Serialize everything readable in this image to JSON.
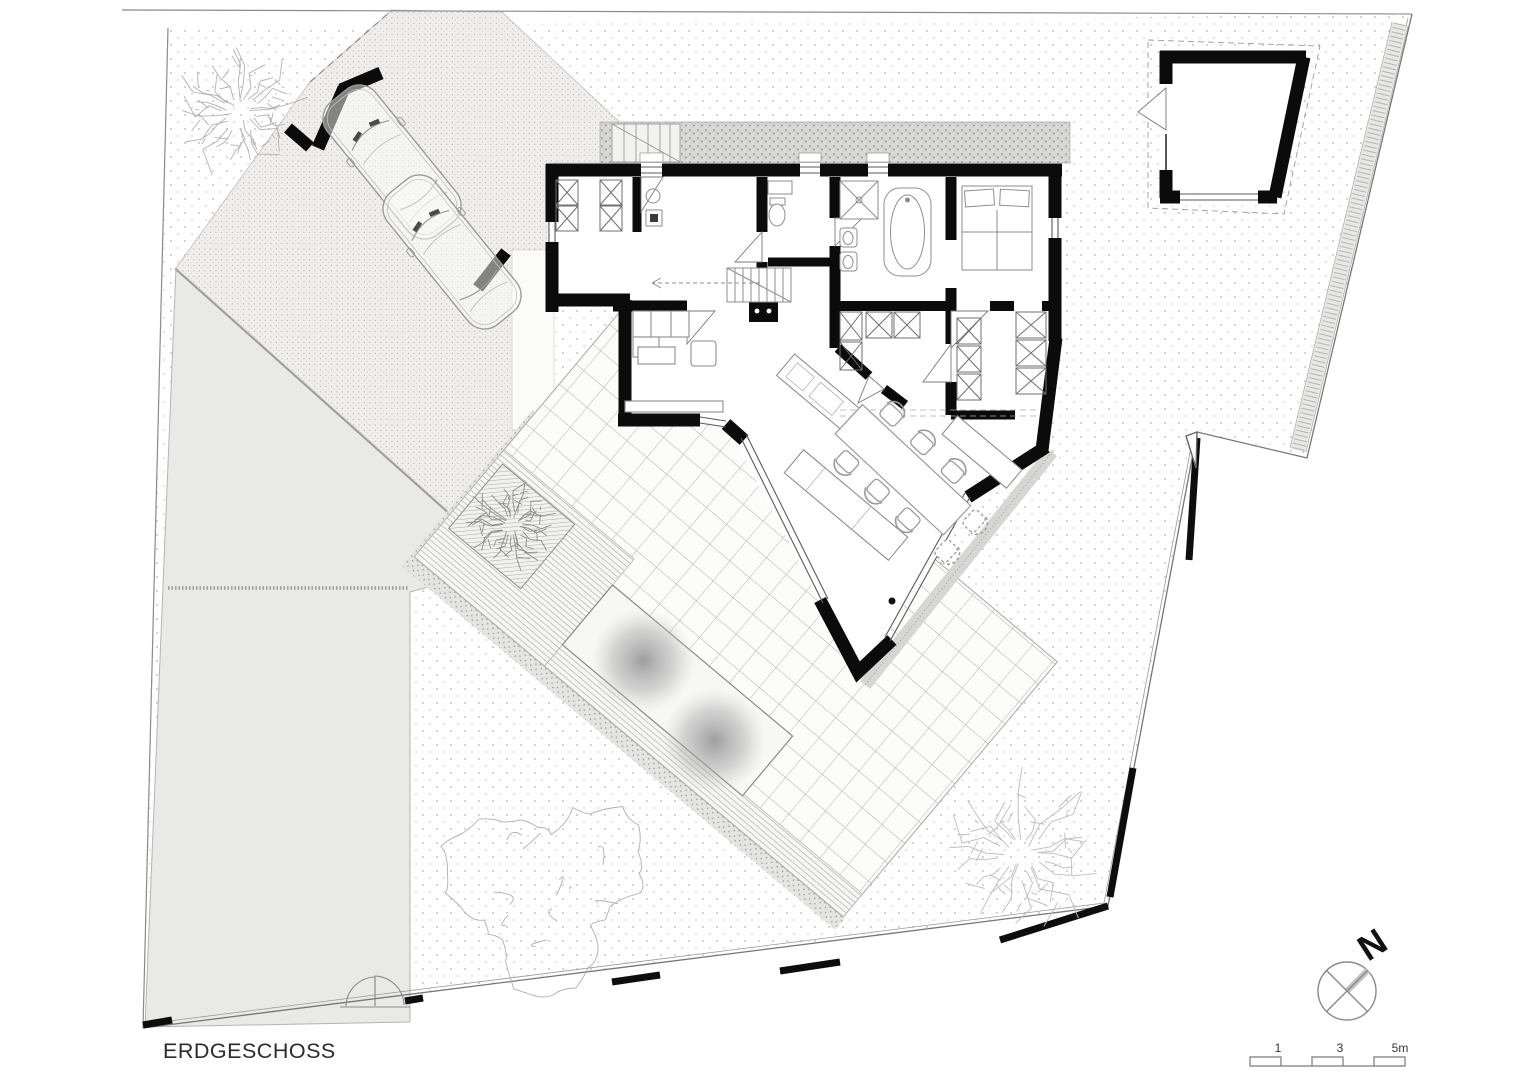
{
  "title": {
    "label": "ERDGESCHOSS"
  },
  "compass": {
    "north_label": "N"
  },
  "scale_bar": {
    "labels": [
      "1",
      "3",
      "5m"
    ]
  },
  "site": {
    "cars_in_carport": 2,
    "trees": 4,
    "buildings": 2,
    "pool_present": true
  },
  "colors": {
    "wall": "#0b0b0b",
    "furniture_line": "#8e8e8e",
    "driveway_fill": "#e9e9e9",
    "lawn_dot": "#c9c9c9",
    "boundary": "#1a1a1a",
    "text": "#2c2c2c",
    "paving_fill": "#efeeec",
    "gravel_fill": "#dadada"
  }
}
